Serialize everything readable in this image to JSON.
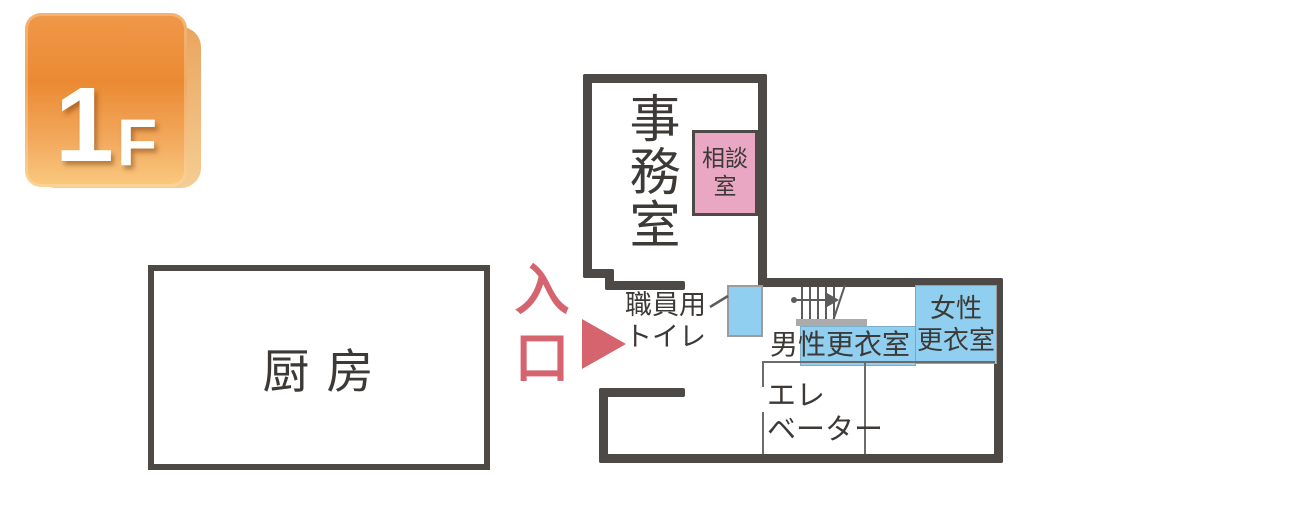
{
  "floor_badge": {
    "number": "1",
    "suffix": "F"
  },
  "rooms": {
    "kitchen": {
      "label": "厨 房"
    },
    "office": {
      "label": "事務室"
    },
    "consultation": {
      "line1": "相談",
      "line2": "室"
    },
    "staff_toilet": {
      "line1": "職員用",
      "line2": "トイレ"
    },
    "mens_locker": {
      "label": "男性更衣室"
    },
    "womens_locker": {
      "line1": "女性",
      "line2": "更衣室"
    },
    "elevator": {
      "line1": "エレ",
      "line2": "ベーター"
    }
  },
  "entrance": {
    "char1": "入",
    "char2": "口"
  },
  "icons": {
    "stairs": "stairs-with-up-arrow",
    "entrance_arrow": "right-pointing-triangle"
  },
  "colors": {
    "wall": "#4D4947",
    "ink": "#3C3936",
    "pink": "#EAA7C3",
    "blue": "#90CFEF",
    "red": "#D6646F",
    "stair": "#5C5C5C",
    "graybar": "#ABABAB",
    "badge-orange-top": "#EF9849",
    "badge-orange-mid": "#EB8A33",
    "badge-orange-bottom": "#F9CA80",
    "badge-back-top": "#EAA55F",
    "badge-back-bottom": "#F5CD93"
  }
}
